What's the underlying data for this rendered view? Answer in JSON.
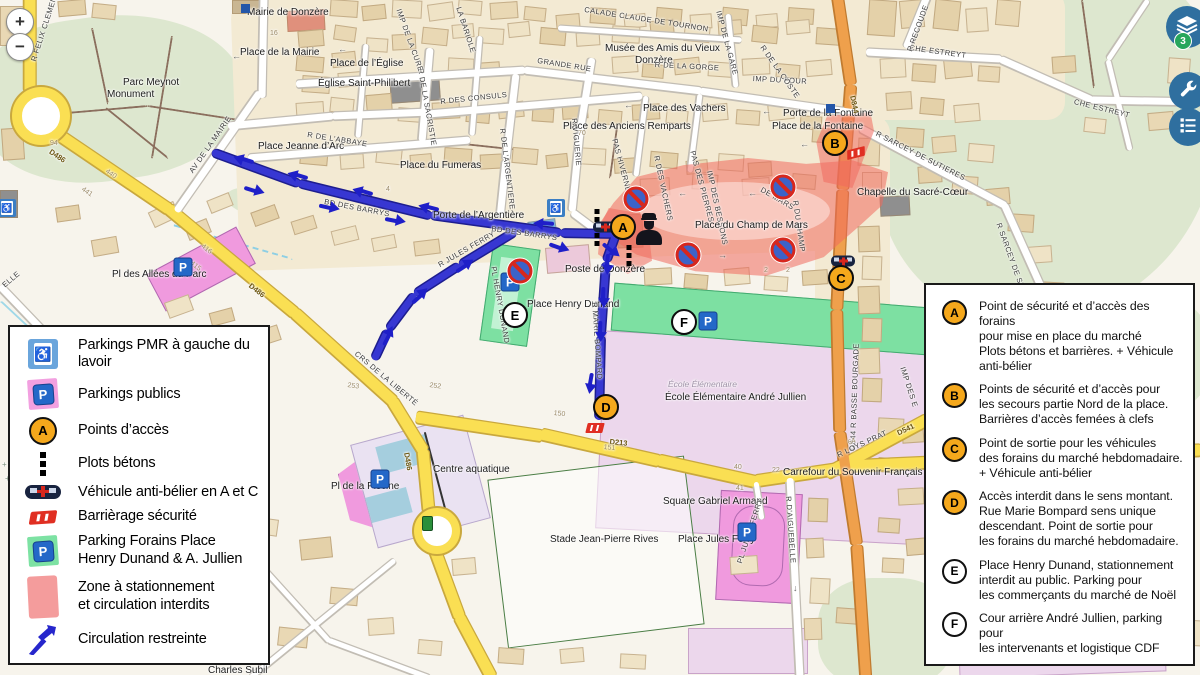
{
  "controls": {
    "zoom_in": "+",
    "zoom_out": "−",
    "layers_badge": "3"
  },
  "colors": {
    "road_yellow": "#fadf53",
    "road_yellow_casing": "#c9a83e",
    "road_orange": "#efa04c",
    "road_orange_casing": "#c07b30",
    "road_white": "#ffffff",
    "road_casing": "#c2bdb4",
    "route_blue": "#3737d2",
    "route_blue_casing": "#1d1d8f",
    "zone_red": "rgba(240,105,95,0.55)",
    "parking_pink": "#f09ade",
    "parking_green": "#7de0a2",
    "marker_orange": "#f5a81c",
    "marker_white": "#ffffff",
    "button_blue": "#2f6f9f",
    "badge_green": "#27a65c"
  },
  "legend_left": {
    "items": [
      {
        "icon": "pmr",
        "label": "Parkings PMR à gauche du lavoir"
      },
      {
        "icon": "parking-public",
        "label": "Parkings publics"
      },
      {
        "icon": "access-point",
        "label": "Points d’accès"
      },
      {
        "icon": "bollards",
        "label": "Plots bétons"
      },
      {
        "icon": "ram-vehicle",
        "label": "Véhicule anti-bélier en A et C"
      },
      {
        "icon": "barrier",
        "label": "Barrièrage sécurité"
      },
      {
        "icon": "parking-forains",
        "label": "Parking Forains Place\nHenry Dunand & A. Jullien"
      },
      {
        "icon": "zone",
        "label": "Zone à stationnement\net circulation interdits"
      },
      {
        "icon": "arrow",
        "label": "Circulation restreinte"
      }
    ]
  },
  "legend_right": {
    "items": [
      {
        "marker": "A",
        "style": "orange",
        "text": "Point de sécurité et d’accès des forains\npour mise en place du marché\nPlots bétons et barrières. + Véhicule\nanti-bélier"
      },
      {
        "marker": "B",
        "style": "orange",
        "text": "Points de sécurité et d’accès pour\nles secours partie Nord de la place.\nBarrières d’accès femées à clefs"
      },
      {
        "marker": "C",
        "style": "orange",
        "text": "Point de sortie pour les véhicules\ndes forains du marché hebdomadaire.\n+ Véhicule anti-bélier"
      },
      {
        "marker": "D",
        "style": "orange",
        "text": "Accès interdit dans le sens montant.\nRue Marie Bompard sens unique\ndescendant. Point de sortie pour\nles forains du marché hebdomadaire."
      },
      {
        "marker": "E",
        "style": "white",
        "text": "Place Henry Dunand, stationnement\ninterdit au public. Parking pour\nles commerçants du marché de Noël"
      },
      {
        "marker": "F",
        "style": "white",
        "text": "Cour arrière André Jullien, parking pour\nles intervenants et logistique CDF"
      }
    ]
  },
  "markers": [
    {
      "letter": "A",
      "style": "orange",
      "x": 623,
      "y": 227
    },
    {
      "letter": "B",
      "style": "orange",
      "x": 835,
      "y": 143
    },
    {
      "letter": "C",
      "style": "orange",
      "x": 841,
      "y": 278
    },
    {
      "letter": "D",
      "style": "orange",
      "x": 606,
      "y": 407
    },
    {
      "letter": "E",
      "style": "white",
      "x": 515,
      "y": 315
    },
    {
      "letter": "F",
      "style": "white",
      "x": 684,
      "y": 322
    }
  ],
  "map_icons": {
    "no_parking": [
      [
        636,
        199
      ],
      [
        783,
        187
      ],
      [
        688,
        255
      ],
      [
        783,
        250
      ],
      [
        520,
        271
      ]
    ],
    "pmr": [
      [
        556,
        208
      ],
      [
        7,
        208
      ]
    ],
    "parking_p": [
      [
        183,
        267
      ],
      [
        510,
        282
      ],
      [
        708,
        321
      ],
      [
        380,
        479
      ],
      [
        747,
        532
      ]
    ],
    "vehicles": [
      [
        605,
        228
      ],
      [
        843,
        262
      ]
    ],
    "barriers": [
      [
        856,
        153,
        -15
      ],
      [
        595,
        428,
        0
      ]
    ],
    "bollard_columns": [
      {
        "x": 597,
        "y": 209,
        "n": 5
      },
      {
        "x": 629,
        "y": 245,
        "n": 3
      }
    ],
    "police": [
      [
        649,
        229
      ]
    ],
    "route_arrows": [
      [
        243,
        160,
        198
      ],
      [
        297,
        176,
        197
      ],
      [
        362,
        192,
        197
      ],
      [
        428,
        208,
        195
      ],
      [
        543,
        224,
        185
      ],
      [
        255,
        190,
        17
      ],
      [
        330,
        207,
        13
      ],
      [
        396,
        220,
        11
      ],
      [
        560,
        247,
        20
      ],
      [
        612,
        250,
        40
      ],
      [
        608,
        265,
        95
      ],
      [
        604,
        298,
        92
      ],
      [
        601,
        332,
        92
      ],
      [
        591,
        384,
        100
      ],
      [
        465,
        265,
        -33
      ],
      [
        420,
        295,
        -42
      ],
      [
        388,
        335,
        -63
      ]
    ],
    "traffic_light": [
      [
        422,
        516
      ]
    ],
    "blue_squares": [
      [
        241,
        4
      ],
      [
        826,
        104
      ]
    ]
  },
  "map_labels": [
    {
      "t": "Mairie de Donzère",
      "x": 247,
      "y": 7,
      "r": 0,
      "c": "pl"
    },
    {
      "t": "Place de la Mairie",
      "x": 240,
      "y": 47,
      "r": 0,
      "c": "pl"
    },
    {
      "t": "Place de l’Église",
      "x": 330,
      "y": 58,
      "r": 0,
      "c": "pl"
    },
    {
      "t": "Église Saint-Philibert",
      "x": 318,
      "y": 78,
      "r": 0,
      "c": "pl"
    },
    {
      "t": "CALADE CLAUDE DE TOURNON",
      "x": 585,
      "y": 6,
      "r": 9,
      "c": "st"
    },
    {
      "t": "Musée des Amis du Vieux",
      "x": 605,
      "y": 43,
      "r": 0,
      "c": "pl"
    },
    {
      "t": "Donzère",
      "x": 635,
      "y": 55,
      "r": 0,
      "c": "pl"
    },
    {
      "t": "GRANDE RUE",
      "x": 538,
      "y": 57,
      "r": 9,
      "c": "st"
    },
    {
      "t": "R DE LA GORGE",
      "x": 655,
      "y": 61,
      "r": 3,
      "c": "st"
    },
    {
      "t": "IMP DU FOUR",
      "x": 753,
      "y": 75,
      "r": 3,
      "c": "st"
    },
    {
      "t": "R DE LA COSTE",
      "x": 765,
      "y": 44,
      "r": 55,
      "c": "st"
    },
    {
      "t": "Place des Vachers",
      "x": 643,
      "y": 103,
      "r": 0,
      "c": "pl"
    },
    {
      "t": "Porte de la Fontaine",
      "x": 783,
      "y": 108,
      "r": 0,
      "c": "pl"
    },
    {
      "t": "Place de la Fontaine",
      "x": 772,
      "y": 121,
      "r": 0,
      "c": "pl"
    },
    {
      "t": "Place des Anciens Remparts",
      "x": 563,
      "y": 121,
      "r": 0,
      "c": "pl"
    },
    {
      "t": "Place Jeanne d’Arc",
      "x": 258,
      "y": 141,
      "r": 0,
      "c": "pl"
    },
    {
      "t": "R DE L’ABBAYE",
      "x": 308,
      "y": 131,
      "r": 9,
      "c": "st"
    },
    {
      "t": "Place du Fumeras",
      "x": 400,
      "y": 160,
      "r": 0,
      "c": "pl"
    },
    {
      "t": "Porte de l’Argentière",
      "x": 433,
      "y": 210,
      "r": 0,
      "c": "pl"
    },
    {
      "t": "R DE L’ARGENTIERE",
      "x": 506,
      "y": 128,
      "r": 83,
      "c": "st"
    },
    {
      "t": "R VIGUERIE",
      "x": 578,
      "y": 118,
      "r": 85,
      "c": "st"
    },
    {
      "t": "R DES CONSULS",
      "x": 440,
      "y": 98,
      "r": -6,
      "c": "st"
    },
    {
      "t": "R DE LA SACRISTIE",
      "x": 424,
      "y": 68,
      "r": 80,
      "c": "st"
    },
    {
      "t": "IMP DE LA CURE",
      "x": 402,
      "y": 8,
      "r": 70,
      "c": "st"
    },
    {
      "t": "IMP DE LA GARE",
      "x": 722,
      "y": 10,
      "r": 75,
      "c": "st"
    },
    {
      "t": "LA BARIOLE",
      "x": 462,
      "y": 6,
      "r": 72,
      "c": "st"
    },
    {
      "t": "R FELIX CLEMENT",
      "x": 30,
      "y": 60,
      "r": -72,
      "c": "st"
    },
    {
      "t": "Parc Meynot",
      "x": 123,
      "y": 77,
      "r": 0,
      "c": "pl"
    },
    {
      "t": "Monument",
      "x": 107,
      "y": 89,
      "r": 0,
      "c": "pl"
    },
    {
      "t": "AV DE LA MAIRIE",
      "x": 188,
      "y": 170,
      "r": -55,
      "c": "st"
    },
    {
      "t": "BD DES BARRYS",
      "x": 325,
      "y": 198,
      "r": 11,
      "c": "st"
    },
    {
      "t": "BD DES BARRYS",
      "x": 492,
      "y": 225,
      "r": 8,
      "c": "st"
    },
    {
      "t": "PAS HIVERNET",
      "x": 618,
      "y": 138,
      "r": 75,
      "c": "st"
    },
    {
      "t": "R DES VACHERS",
      "x": 660,
      "y": 155,
      "r": 78,
      "c": "st"
    },
    {
      "t": "PAS DES PIERRES",
      "x": 696,
      "y": 150,
      "r": 75,
      "c": "st"
    },
    {
      "t": "IMP DES BESSONS",
      "x": 713,
      "y": 170,
      "r": 78,
      "c": "st"
    },
    {
      "t": "DE MARS",
      "x": 763,
      "y": 186,
      "r": 30,
      "c": "st"
    },
    {
      "t": "R DU CHAMP",
      "x": 799,
      "y": 200,
      "r": 82,
      "c": "st"
    },
    {
      "t": "Place du Champ de Mars",
      "x": 695,
      "y": 220,
      "r": 0,
      "c": "pl"
    },
    {
      "t": "Chapelle du Sacré-Cœur",
      "x": 857,
      "y": 187,
      "r": 0,
      "c": "pl"
    },
    {
      "t": "R SARCEY DE SUTIERES",
      "x": 878,
      "y": 130,
      "r": 27,
      "c": "st"
    },
    {
      "t": "R SARCEY DE SU",
      "x": 1002,
      "y": 222,
      "r": 70,
      "c": "st"
    },
    {
      "t": "CHE ESTREYT",
      "x": 910,
      "y": 44,
      "r": 8,
      "c": "st"
    },
    {
      "t": "CHE ESTREYT",
      "x": 1075,
      "y": 98,
      "r": 14,
      "c": "st"
    },
    {
      "t": "R RECOUDE",
      "x": 906,
      "y": 50,
      "r": -70,
      "c": "st"
    },
    {
      "t": "D844",
      "x": 856,
      "y": 95,
      "r": 78,
      "c": "ref"
    },
    {
      "t": "D844 R BASSE BOURGADE",
      "x": 849,
      "y": 450,
      "r": -88,
      "c": "st"
    },
    {
      "t": "IMP DES E",
      "x": 906,
      "y": 366,
      "r": 72,
      "c": "st"
    },
    {
      "t": "R LOYS PRAT",
      "x": 836,
      "y": 452,
      "r": -25,
      "c": "st"
    },
    {
      "t": "D541",
      "x": 896,
      "y": 430,
      "r": -25,
      "c": "ref"
    },
    {
      "t": "Carrefour du Souvenir Français",
      "x": 783,
      "y": 467,
      "r": 0,
      "c": "pl"
    },
    {
      "t": "Square Gabriel Armand",
      "x": 663,
      "y": 496,
      "r": 0,
      "c": "pl"
    },
    {
      "t": "Place Jules Ferry",
      "x": 678,
      "y": 534,
      "r": 0,
      "c": "pl"
    },
    {
      "t": "PL JULES FERRY",
      "x": 736,
      "y": 562,
      "r": -72,
      "c": "st"
    },
    {
      "t": "R D'AIGUEBELLE",
      "x": 792,
      "y": 496,
      "r": 86,
      "c": "st"
    },
    {
      "t": "Stade Jean-Pierre Rives",
      "x": 550,
      "y": 534,
      "r": 0,
      "c": "pl"
    },
    {
      "t": "Centre aquatique",
      "x": 433,
      "y": 464,
      "r": 0,
      "c": "pl"
    },
    {
      "t": "Pl de la Piscine",
      "x": 331,
      "y": 481,
      "r": 0,
      "c": "pl"
    },
    {
      "t": "Pl des Allées du Parc",
      "x": 112,
      "y": 269,
      "r": 0,
      "c": "pl"
    },
    {
      "t": "Poste de Donzère",
      "x": 565,
      "y": 264,
      "r": 0,
      "c": "pl"
    },
    {
      "t": "Place Henry Dunand",
      "x": 527,
      "y": 299,
      "r": 0,
      "c": "pl"
    },
    {
      "t": "PL HENRY DUNAND",
      "x": 497,
      "y": 266,
      "r": 80,
      "c": "st"
    },
    {
      "t": "R JULES FERRY",
      "x": 437,
      "y": 262,
      "r": -30,
      "c": "st"
    },
    {
      "t": "R MARIE BOMPARD",
      "x": 598,
      "y": 302,
      "r": 86,
      "c": "st"
    },
    {
      "t": "École Élémentaire",
      "x": 668,
      "y": 380,
      "r": 0,
      "c": "sti"
    },
    {
      "t": "École Élémentaire André Jullien",
      "x": 665,
      "y": 392,
      "r": 0,
      "c": "pl"
    },
    {
      "t": "CRS DE LA LIBERTÉ",
      "x": 358,
      "y": 350,
      "r": 40,
      "c": "st"
    },
    {
      "t": "D486",
      "x": 52,
      "y": 148,
      "r": 34,
      "c": "ref"
    },
    {
      "t": "D486",
      "x": 252,
      "y": 282,
      "r": 38,
      "c": "ref"
    },
    {
      "t": "D486",
      "x": 410,
      "y": 452,
      "r": 80,
      "c": "ref"
    },
    {
      "t": "D213",
      "x": 610,
      "y": 438,
      "r": 6,
      "c": "ref"
    },
    {
      "t": "ELLE",
      "x": 1,
      "y": 283,
      "r": -40,
      "c": "st"
    },
    {
      "t": "Charles Subil",
      "x": 208,
      "y": 665,
      "r": 0,
      "c": "pl"
    },
    {
      "t": "16",
      "x": 270,
      "y": 30,
      "r": 0,
      "c": "num"
    },
    {
      "t": "94",
      "x": 50,
      "y": 140,
      "r": 0,
      "c": "num"
    },
    {
      "t": "440",
      "x": 108,
      "y": 168,
      "r": 34,
      "c": "num"
    },
    {
      "t": "441",
      "x": 84,
      "y": 186,
      "r": 34,
      "c": "num"
    },
    {
      "t": "416",
      "x": 204,
      "y": 243,
      "r": 38,
      "c": "num"
    },
    {
      "t": "415",
      "x": 193,
      "y": 260,
      "r": 38,
      "c": "num"
    },
    {
      "t": "252",
      "x": 430,
      "y": 382,
      "r": 8,
      "c": "num"
    },
    {
      "t": "253",
      "x": 348,
      "y": 382,
      "r": 8,
      "c": "num"
    },
    {
      "t": "150",
      "x": 554,
      "y": 410,
      "r": 6,
      "c": "num"
    },
    {
      "t": "151",
      "x": 604,
      "y": 444,
      "r": 6,
      "c": "num"
    },
    {
      "t": "40",
      "x": 734,
      "y": 464,
      "r": 0,
      "c": "num"
    },
    {
      "t": "22",
      "x": 772,
      "y": 467,
      "r": 0,
      "c": "num"
    },
    {
      "t": "41",
      "x": 736,
      "y": 485,
      "r": 0,
      "c": "num"
    },
    {
      "t": "64",
      "x": 847,
      "y": 440,
      "r": -20,
      "c": "num"
    },
    {
      "t": "2",
      "x": 764,
      "y": 267,
      "r": 0,
      "c": "num"
    },
    {
      "t": "2",
      "x": 786,
      "y": 267,
      "r": 0,
      "c": "num"
    },
    {
      "t": "70",
      "x": 578,
      "y": 130,
      "r": 0,
      "c": "num"
    },
    {
      "t": "4",
      "x": 386,
      "y": 186,
      "r": 0,
      "c": "num"
    },
    {
      "t": "+ + + +",
      "x": 2,
      "y": 460,
      "r": 0,
      "c": "crs"
    },
    {
      "t": "+ + +",
      "x": 5,
      "y": 474,
      "r": 0,
      "c": "crs"
    },
    {
      "t": "←",
      "x": 624,
      "y": 100,
      "r": 0,
      "c": "ow"
    },
    {
      "t": "←",
      "x": 696,
      "y": 102,
      "r": 0,
      "c": "ow"
    },
    {
      "t": "←",
      "x": 762,
      "y": 106,
      "r": 0,
      "c": "ow"
    },
    {
      "t": "←",
      "x": 338,
      "y": 44,
      "r": 0,
      "c": "ow"
    },
    {
      "t": "←",
      "x": 232,
      "y": 51,
      "r": 0,
      "c": "ow"
    },
    {
      "t": "←",
      "x": 678,
      "y": 188,
      "r": 0,
      "c": "ow"
    },
    {
      "t": "←",
      "x": 748,
      "y": 188,
      "r": 0,
      "c": "ow"
    },
    {
      "t": "→",
      "x": 718,
      "y": 250,
      "r": 0,
      "c": "ow"
    },
    {
      "t": "←",
      "x": 800,
      "y": 139,
      "r": 0,
      "c": "ow"
    },
    {
      "t": "↓",
      "x": 793,
      "y": 583,
      "r": 0,
      "c": "ow"
    }
  ]
}
